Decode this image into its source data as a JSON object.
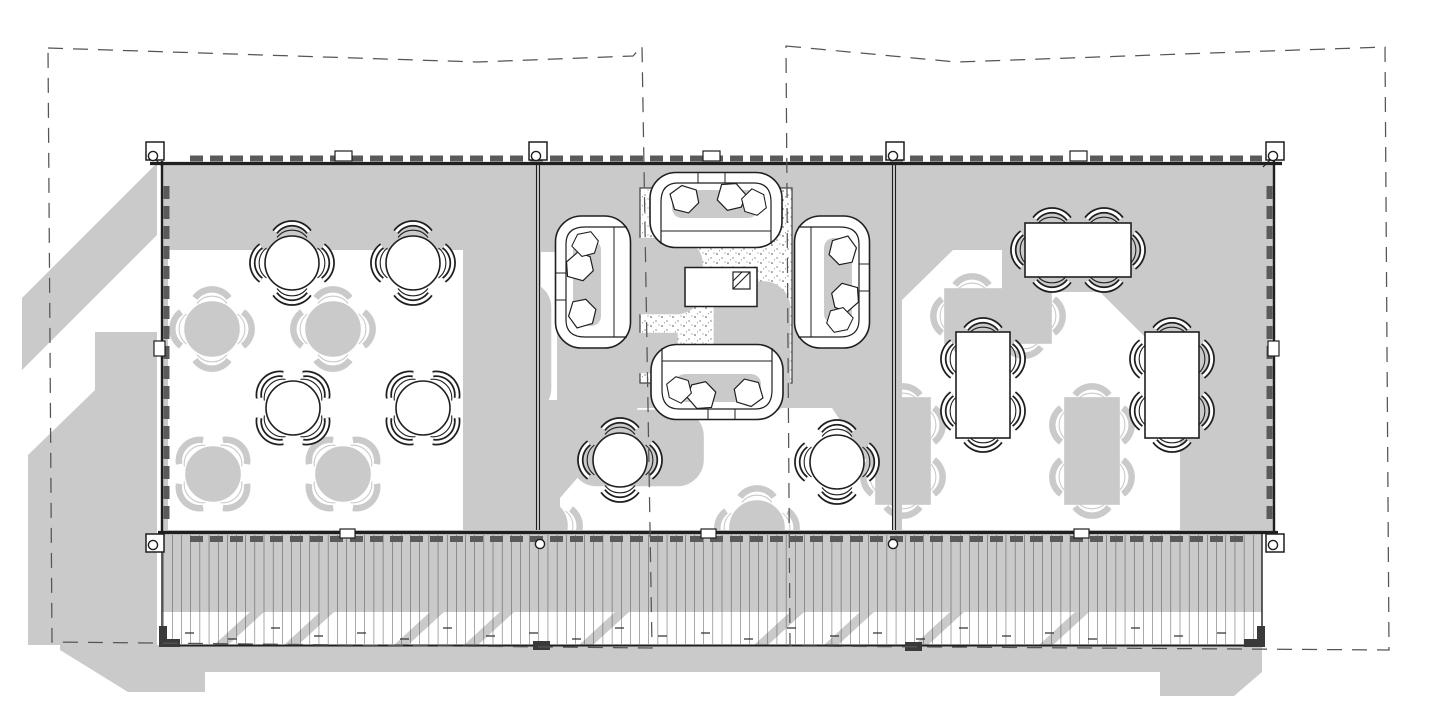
{
  "document": {
    "kind": "architectural-floor-plan",
    "visible_text": "",
    "description_data": {
      "modules": [
        {
          "id": "left-dining-room",
          "furniture": {
            "round_tables_4_chairs": 4
          }
        },
        {
          "id": "center-lounge",
          "furniture": {
            "sofas": 4,
            "coffee_tables": 1,
            "rugs": 1,
            "round_tables_4_chairs": 2
          }
        },
        {
          "id": "right-dining-room",
          "furniture": {
            "rect_tables_6_chairs": 3
          }
        }
      ],
      "deck": {
        "id": "boardwalk-deck",
        "boards": "vertical planks with staggered joints",
        "posts_with_circles": 8,
        "corner_feet": 4
      },
      "roof": {
        "id": "roof-overhang-outline",
        "style": "dashed",
        "panels": 2
      },
      "shadows": {
        "direction": "cast toward lower-left",
        "style": "flat gray silhouettes"
      }
    }
  },
  "colors": {
    "paper": "#ffffff",
    "ink": "#1f1f1f",
    "shadow": "#cacaca",
    "glazing": "#5a5a5a",
    "board": "#3f3f3f",
    "rugdot": "#3c3c3c",
    "bg": "#ffffff"
  }
}
